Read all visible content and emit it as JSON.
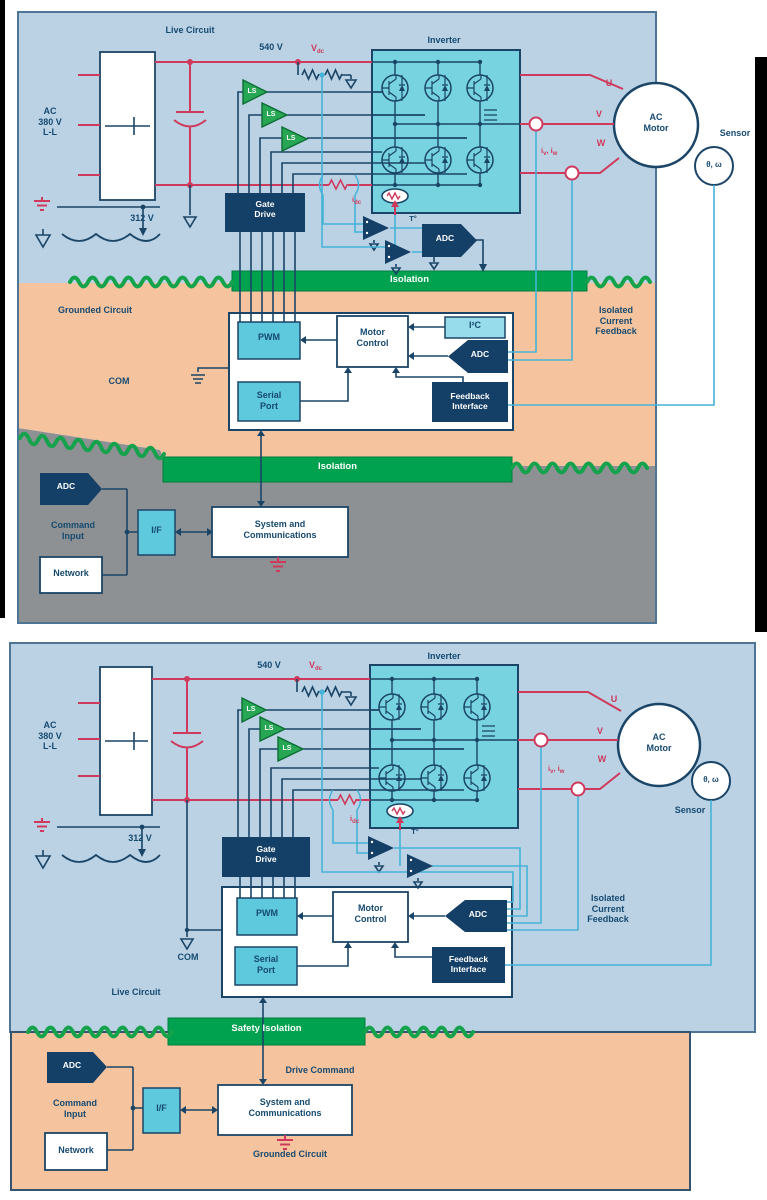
{
  "colors": {
    "live_region_blue": "#bad2e4",
    "grounded_region_salmon": "#f5c49e",
    "command_region_gray": "#8d9193",
    "isolation_green": "#00a14f",
    "box_navy": "#143f66",
    "box_cyan": "#5ec8dc",
    "box_cyan_light": "#96dcea",
    "inverter_fill": "#76d3df",
    "wire_red": "#cf3a5c",
    "wire_cyan": "#45b3d8",
    "wire_navy": "#1b4567",
    "ls_green": "#27a653",
    "text_navy": "#174a70"
  },
  "d1": {
    "live_circuit": "Live Circuit",
    "ac_input": "AC\n380 V\nL-L",
    "v540": "540 V",
    "v312": "312 V",
    "vdc_main": "V",
    "vdc_sub": "dc",
    "idc_main": "i",
    "idc_sub": "dc",
    "inverter": "Inverter",
    "gate_drive": "Gate\nDrive",
    "ls": "LS",
    "t_label": "T°",
    "adc_hot": "ADC",
    "u": "U",
    "v": "V",
    "w": "W",
    "iv_main": "i",
    "iv_sub": "v",
    "ivw_sep": ", ",
    "iw_main": "i",
    "iw_sub": "w",
    "ac_motor": "AC\nMotor",
    "sensor": "Sensor",
    "theta_omega": "θ, ω",
    "isolation_top": "Isolation",
    "grounded_circuit": "Grounded Circuit",
    "com": "COM",
    "pwm": "PWM",
    "motor_control": "Motor\nControl",
    "i2c": "I²C",
    "adc_ctrl": "ADC",
    "serial_port": "Serial\nPort",
    "feedback_interface": "Feedback\nInterface",
    "isolated_current_feedback": "Isolated\nCurrent\nFeedback",
    "isolation_bottom": "Isolation",
    "adc_cmd": "ADC",
    "command_input": "Command\nInput",
    "network": "Network",
    "interface": "I/F",
    "system_comms": "System and\nCommunications"
  },
  "d2": {
    "live_circuit": "Live Circuit",
    "ac_input": "AC\n380 V\nL-L",
    "v540": "540 V",
    "v312": "312 V",
    "vdc_main": "V",
    "vdc_sub": "dc",
    "idc_main": "i",
    "idc_sub": "dc",
    "inverter": "Inverter",
    "gate_drive": "Gate\nDrive",
    "ls": "LS",
    "t_label": "T°",
    "u": "U",
    "v": "V",
    "w": "W",
    "iv_main": "i",
    "iv_sub": "v",
    "ivw_sep": ", ",
    "iw_main": "i",
    "iw_sub": "w",
    "ac_motor": "AC\nMotor",
    "sensor": "Sensor",
    "theta_omega": "θ, ω",
    "com": "COM",
    "pwm": "PWM",
    "motor_control": "Motor\nControl",
    "adc_ctrl": "ADC",
    "serial_port": "Serial\nPort",
    "feedback_interface": "Feedback\nInterface",
    "isolated_current_feedback": "Isolated\nCurrent\nFeedback",
    "safety_isolation": "Safety Isolation",
    "drive_command": "Drive Command",
    "grounded_circuit": "Grounded Circuit",
    "adc_cmd": "ADC",
    "command_input": "Command\nInput",
    "network": "Network",
    "interface": "I/F",
    "system_comms": "System and\nCommunications"
  }
}
